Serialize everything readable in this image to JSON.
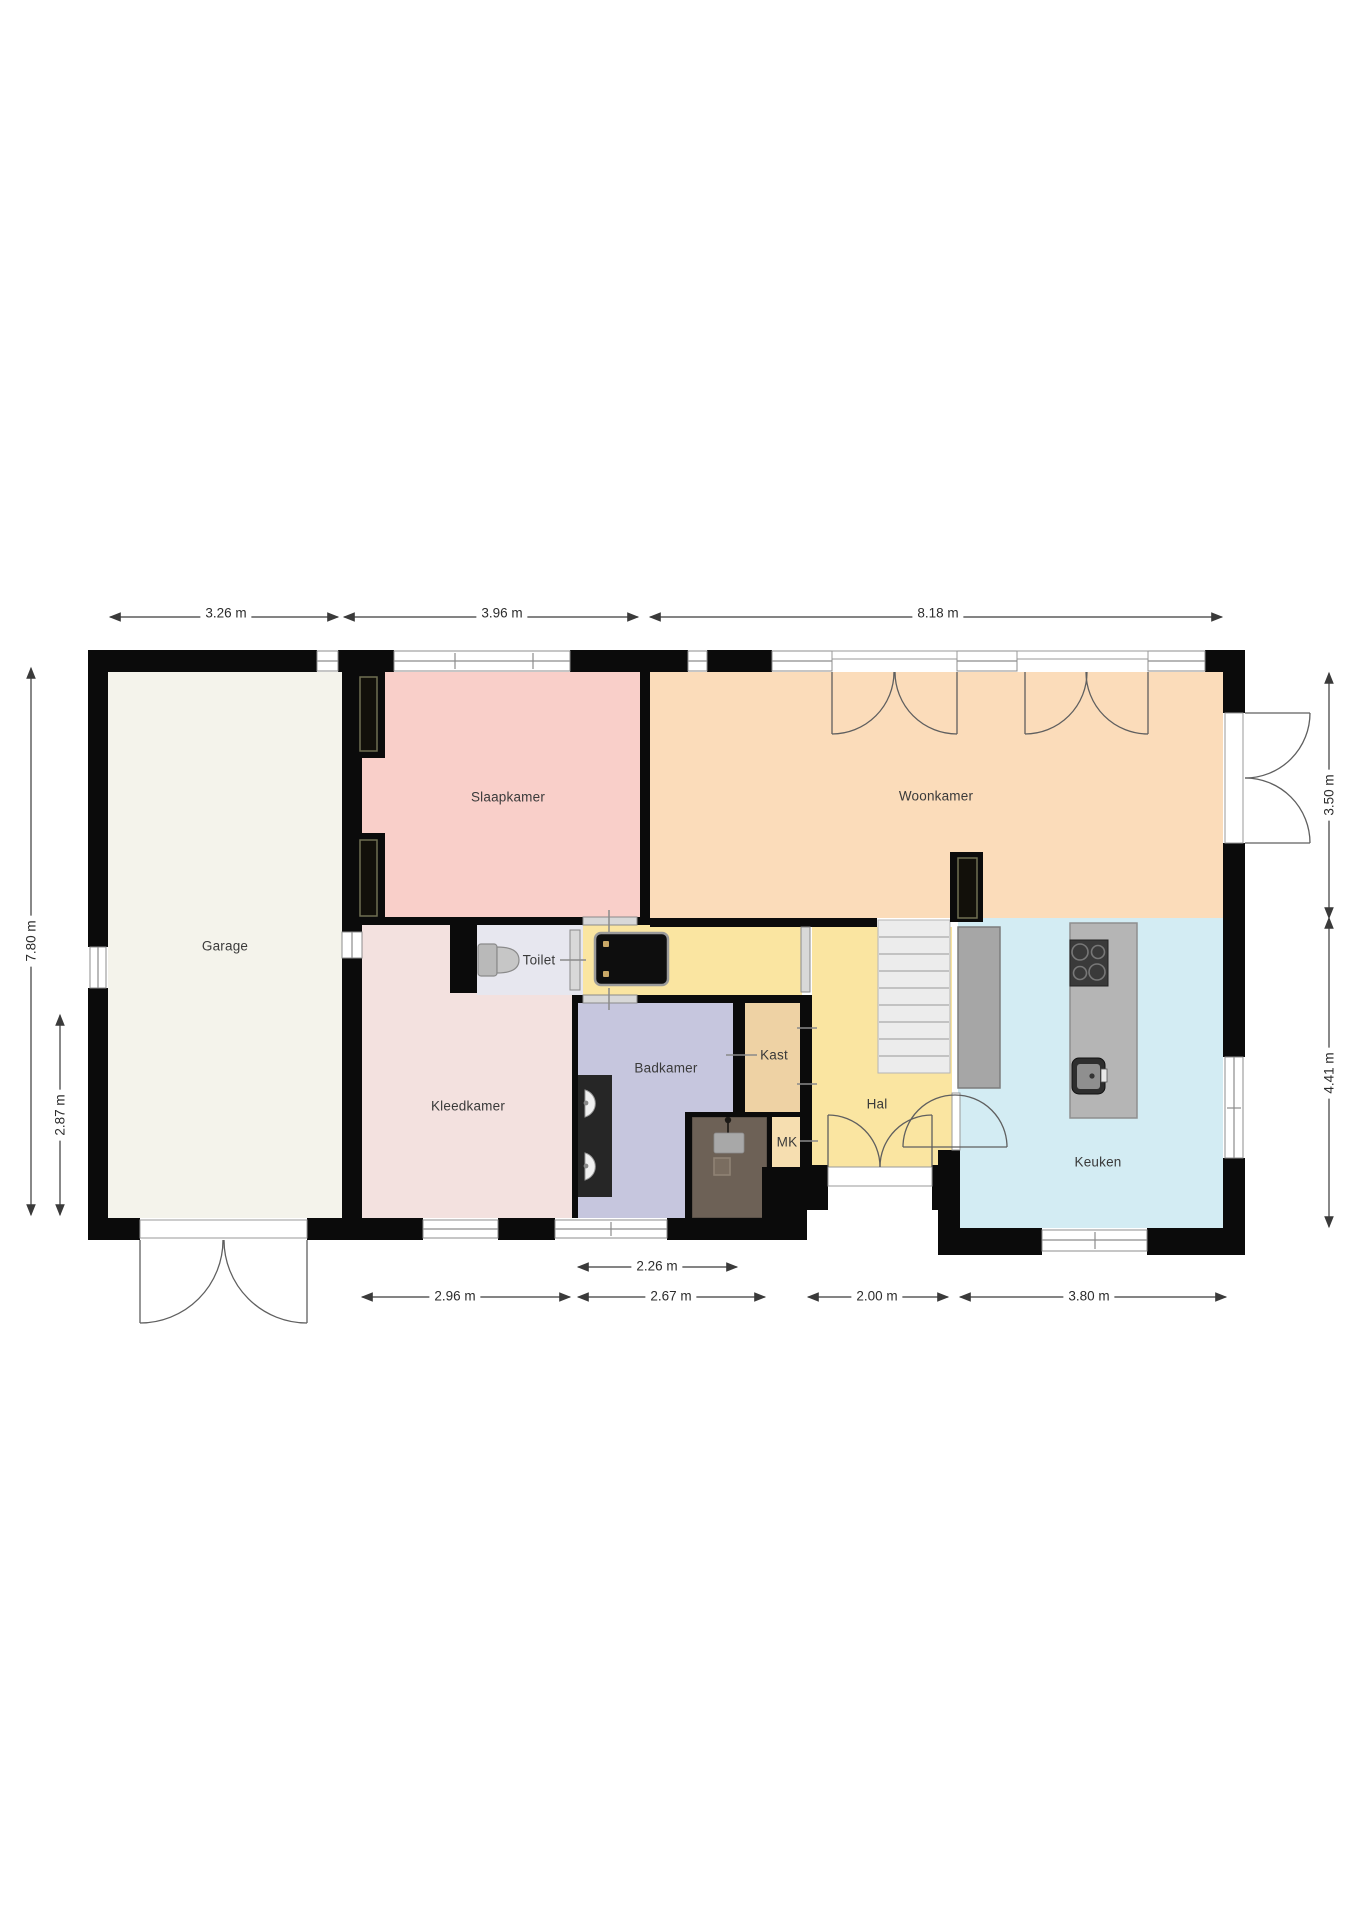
{
  "plan": {
    "type": "floorplan",
    "rooms": {
      "garage": {
        "label": "Garage",
        "color": "#f4f3eb"
      },
      "slaapkamer": {
        "label": "Slaapkamer",
        "color": "#f9cfc9"
      },
      "woonkamer": {
        "label": "Woonkamer",
        "color": "#fbdcba"
      },
      "kleedkamer": {
        "label": "Kleedkamer",
        "color": "#f3e1df"
      },
      "toilet": {
        "label": "Toilet",
        "color": "#e7e7ef"
      },
      "badkamer": {
        "label": "Badkamer",
        "color": "#c6c6de"
      },
      "kast": {
        "label": "Kast",
        "color": "#eed2a4"
      },
      "mk": {
        "label": "MK",
        "color": "#f6deb0"
      },
      "hal": {
        "label": "Hal",
        "color": "#fae5a1"
      },
      "keuken": {
        "label": "Keuken",
        "color": "#d3ecf3"
      }
    },
    "palette": {
      "wall": "#0b0b0b",
      "window_line": "#8c8c8c",
      "dimension_line": "#3a3a3a",
      "door_swing": "#5f5f5f",
      "stairs": "#ececec",
      "divider_panel": "#a6a6a6",
      "kitchen_island": "#b5b5b5",
      "shower": "#6d6156",
      "basin_counter": "#262626",
      "cabinet": "#0e0e0e"
    },
    "dimensions": {
      "top": [
        "3.26 m",
        "3.96 m",
        "8.18 m"
      ],
      "left": [
        "7.80 m",
        "2.87 m"
      ],
      "right": [
        "3.50 m",
        "4.41 m"
      ],
      "bottom": [
        "2.26 m",
        "2.96 m",
        "2.67 m",
        "2.00 m",
        "3.80 m"
      ]
    }
  }
}
